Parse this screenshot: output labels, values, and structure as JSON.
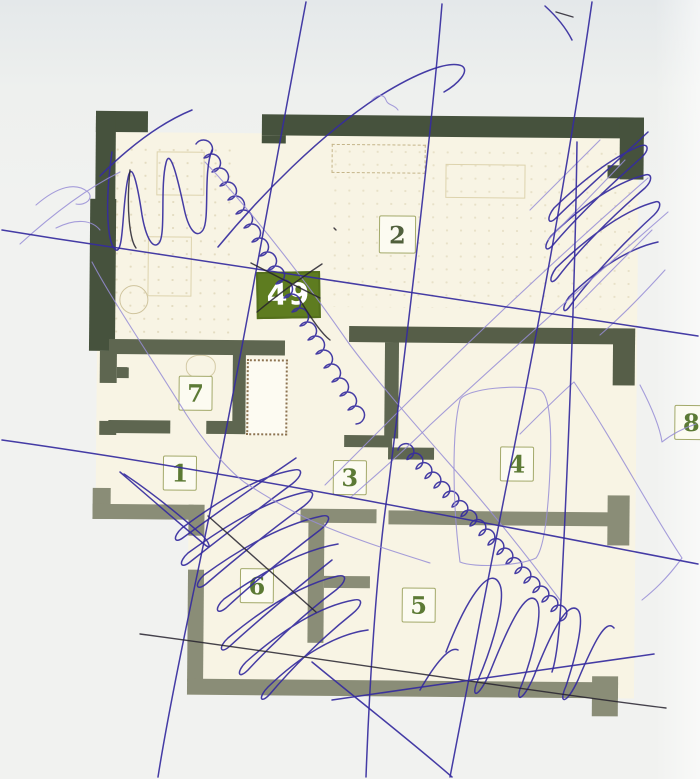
{
  "plan": {
    "badge": {
      "label": "49"
    },
    "rooms": [
      {
        "label": "1"
      },
      {
        "label": "2"
      },
      {
        "label": "3"
      },
      {
        "label": "4"
      },
      {
        "label": "5"
      },
      {
        "label": "6"
      },
      {
        "label": "7"
      },
      {
        "label": "8"
      }
    ]
  },
  "colors": {
    "paper": "#eff0ee",
    "plan_fill": "#f8f4e4",
    "wall_dark": "#46523d",
    "wall_mid": "#5e6650",
    "wall_light": "#8a8d77",
    "pen_blue": "#352b9e",
    "pen_light_purple": "#968dd6",
    "pen_black": "#26222e",
    "badge_green": "#5e7c20",
    "room_number_green": "#5c7a35",
    "room_box_border": "#a3a96a",
    "furniture_tan": "#cfc49d"
  }
}
